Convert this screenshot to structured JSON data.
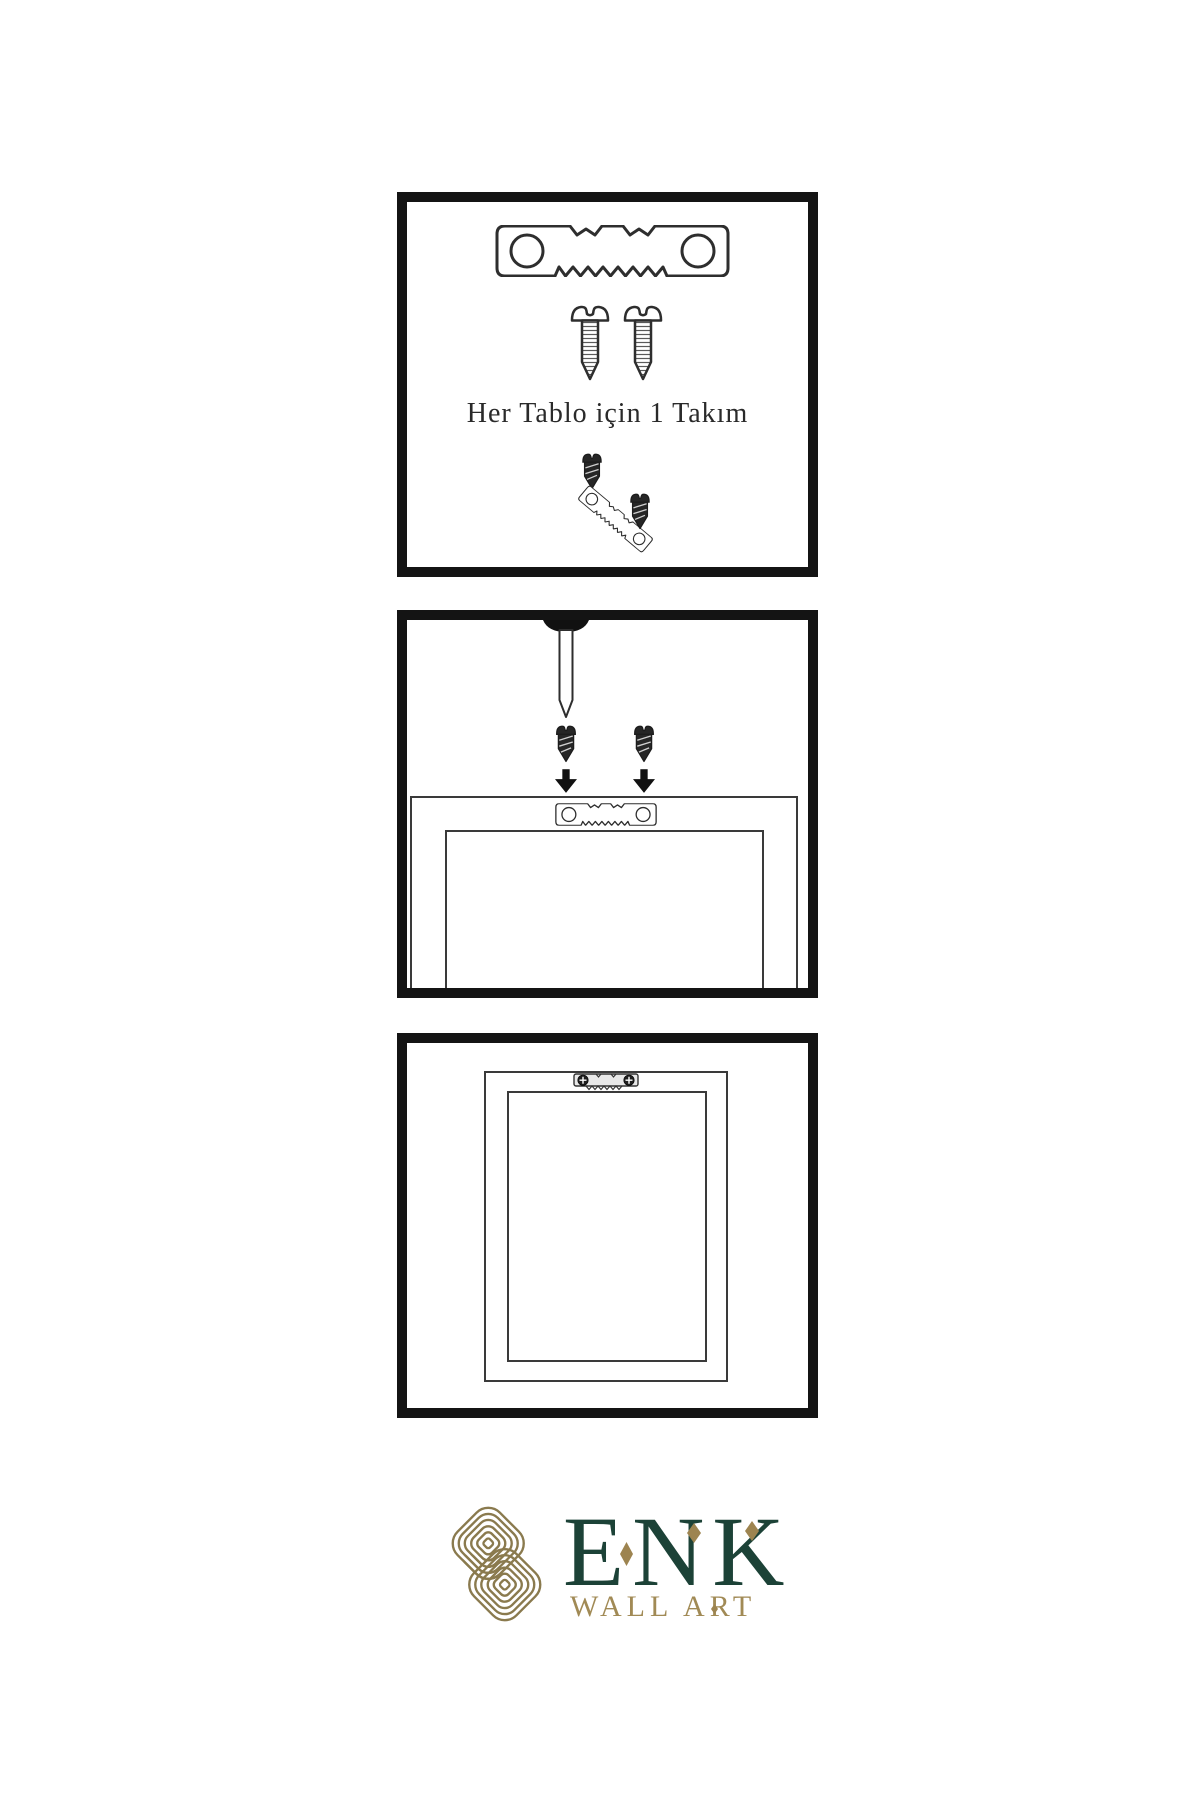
{
  "page": {
    "background": "#ffffff"
  },
  "panel_kit": {
    "caption": "Her Tablo için 1 Takım",
    "items": [
      "sawtooth-hanger-plate",
      "two-mounting-screws",
      "screw-into-hanger-demo"
    ]
  },
  "panel_mount": {
    "items": [
      "wall-nail",
      "two-screws-with-down-arrows",
      "frame-back-with-sawtooth-hanger"
    ]
  },
  "panel_hung": {
    "items": [
      "hung-frame-with-mounted-hanger"
    ]
  },
  "logo": {
    "brand": "ENK",
    "tagline": "WALL ART"
  },
  "colors": {
    "panel_border": "#141414",
    "line_art": "#2e2e2e",
    "dark_hardware_fill": "#262626",
    "brand_green": "#1c4237",
    "knot_gold": "#8a7a4e",
    "accent_gold": "#9d8450",
    "tagline_gold": "#a18a55"
  },
  "icons": {
    "sawtooth_hanger": "serrated hanger plate with two holes",
    "screw_light": "pan-head screw, outlined with threads",
    "screw_dark": "dark tapered screw",
    "arrow_down": "solid black down arrow",
    "nail": "wall nail with dome head",
    "phillips_head": "dark circle with cross slot",
    "knot_mark": "interlaced double-loop knot monogram",
    "diamond_accent": "elongated gold diamond"
  }
}
